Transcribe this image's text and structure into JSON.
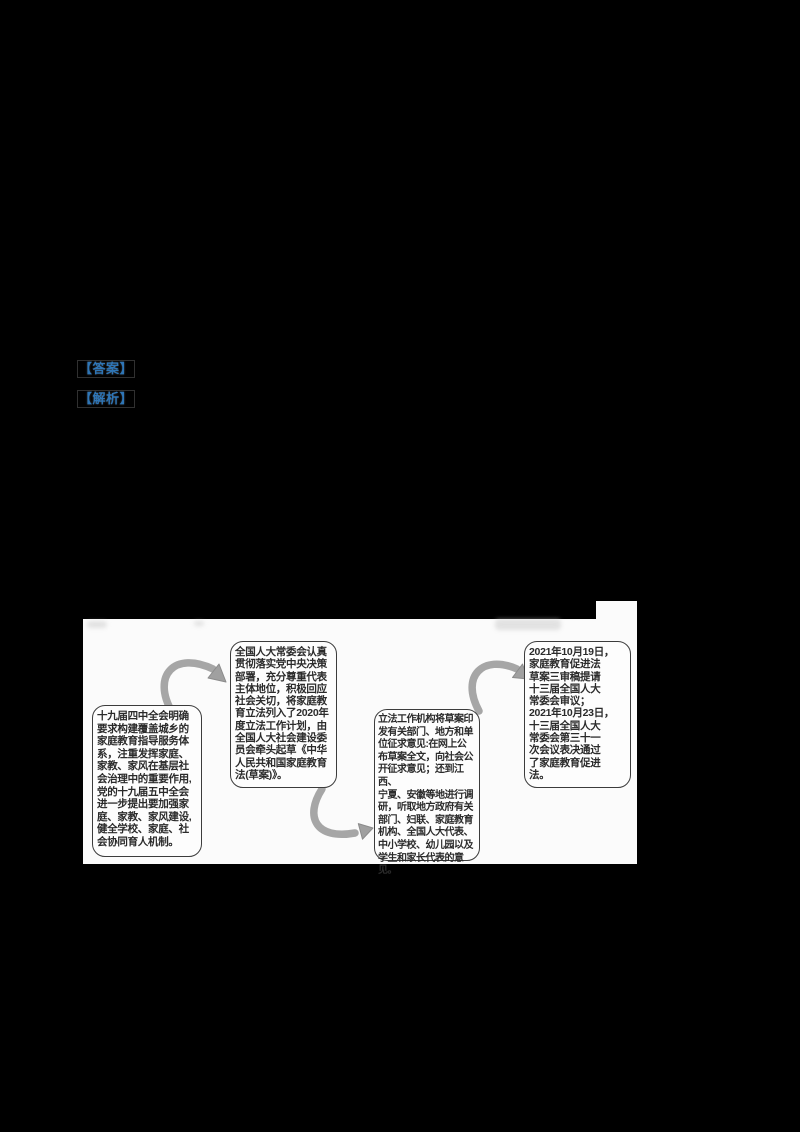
{
  "document": {
    "background": "#000000",
    "labels": {
      "answer": "【答案】",
      "analysis": "【解析】",
      "color": "#2E75B6"
    }
  },
  "flowchart": {
    "panel_bg": "#fbfbfb",
    "box_border_color": "#3c3c3c",
    "arrow_color": "#a6a6a6",
    "steps": [
      {
        "text": "十九届四中全会明确\n要求构建覆盖城乡的\n家庭教育指导服务体\n系，注重发挥家庭、\n家教、家风在基层社\n会治理中的重要作用,\n党的十九届五中全会\n进一步提出要加强家\n庭、家教、家风建设,\n健全学校、家庭、社\n会协同育人机制。"
      },
      {
        "text": "全国人大常委会认真\n贯彻落实党中央决策\n部署，充分尊重代表\n主体地位，积极回应\n社会关切，将家庭教\n育立法列入了2020年\n度立法工作计划，由\n全国人大社会建设委\n员会牵头起草《中华\n人民共和国家庭教育\n法(草案)》。"
      },
      {
        "text": "立法工作机构将草案印\n发有关部门、地方和单\n位征求意见:在网上公\n布草案全文，向社会公\n开征求意见；还到江西、\n宁夏、安徽等地进行调\n研，听取地方政府有关\n部门、妇联、家庭教育\n机构、全国人大代表、\n中小学校、幼儿园以及\n学生和家长代表的意见。"
      },
      {
        "text": "2021年10月19日，\n家庭教育促进法\n草案三审稿提请\n十三届全国人大\n常委会审议；\n2021年10月23日，\n十三届全国人大\n常委会第三十一\n次会议表决通过\n了家庭教育促进\n法。"
      }
    ]
  }
}
